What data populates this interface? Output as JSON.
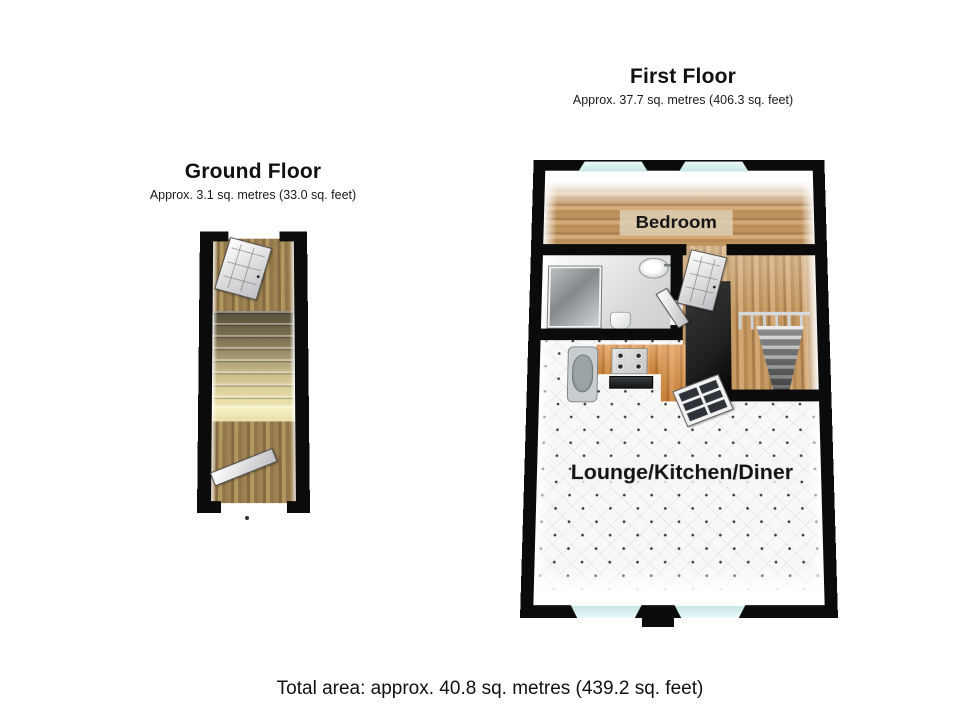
{
  "ground_floor": {
    "title": "Ground Floor",
    "subtitle": "Approx. 3.1 sq. metres (33.0 sq. feet)"
  },
  "first_floor": {
    "title": "First Floor",
    "subtitle": "Approx. 37.7 sq. metres (406.3 sq. feet)",
    "rooms": {
      "bedroom": "Bedroom",
      "lounge": "Lounge/Kitchen/Diner"
    }
  },
  "footer": {
    "total_area": "Total area: approx. 40.8 sq. metres (439.2 sq. feet)"
  },
  "colors": {
    "wall": "#0b0b0b",
    "glass": "#c6e6e4",
    "bedroom_floor": "#c0945f",
    "landing_floor": "#c79a63",
    "hall_floor": "#9d8252",
    "stair_tread": "#cbbc8c",
    "stair_bottom": "#f2eaba",
    "counter": "#d78a3c",
    "carpet": "#f8f8f8",
    "carpet_dot": "#3c3c3c",
    "partition": "#1f1f1f"
  }
}
